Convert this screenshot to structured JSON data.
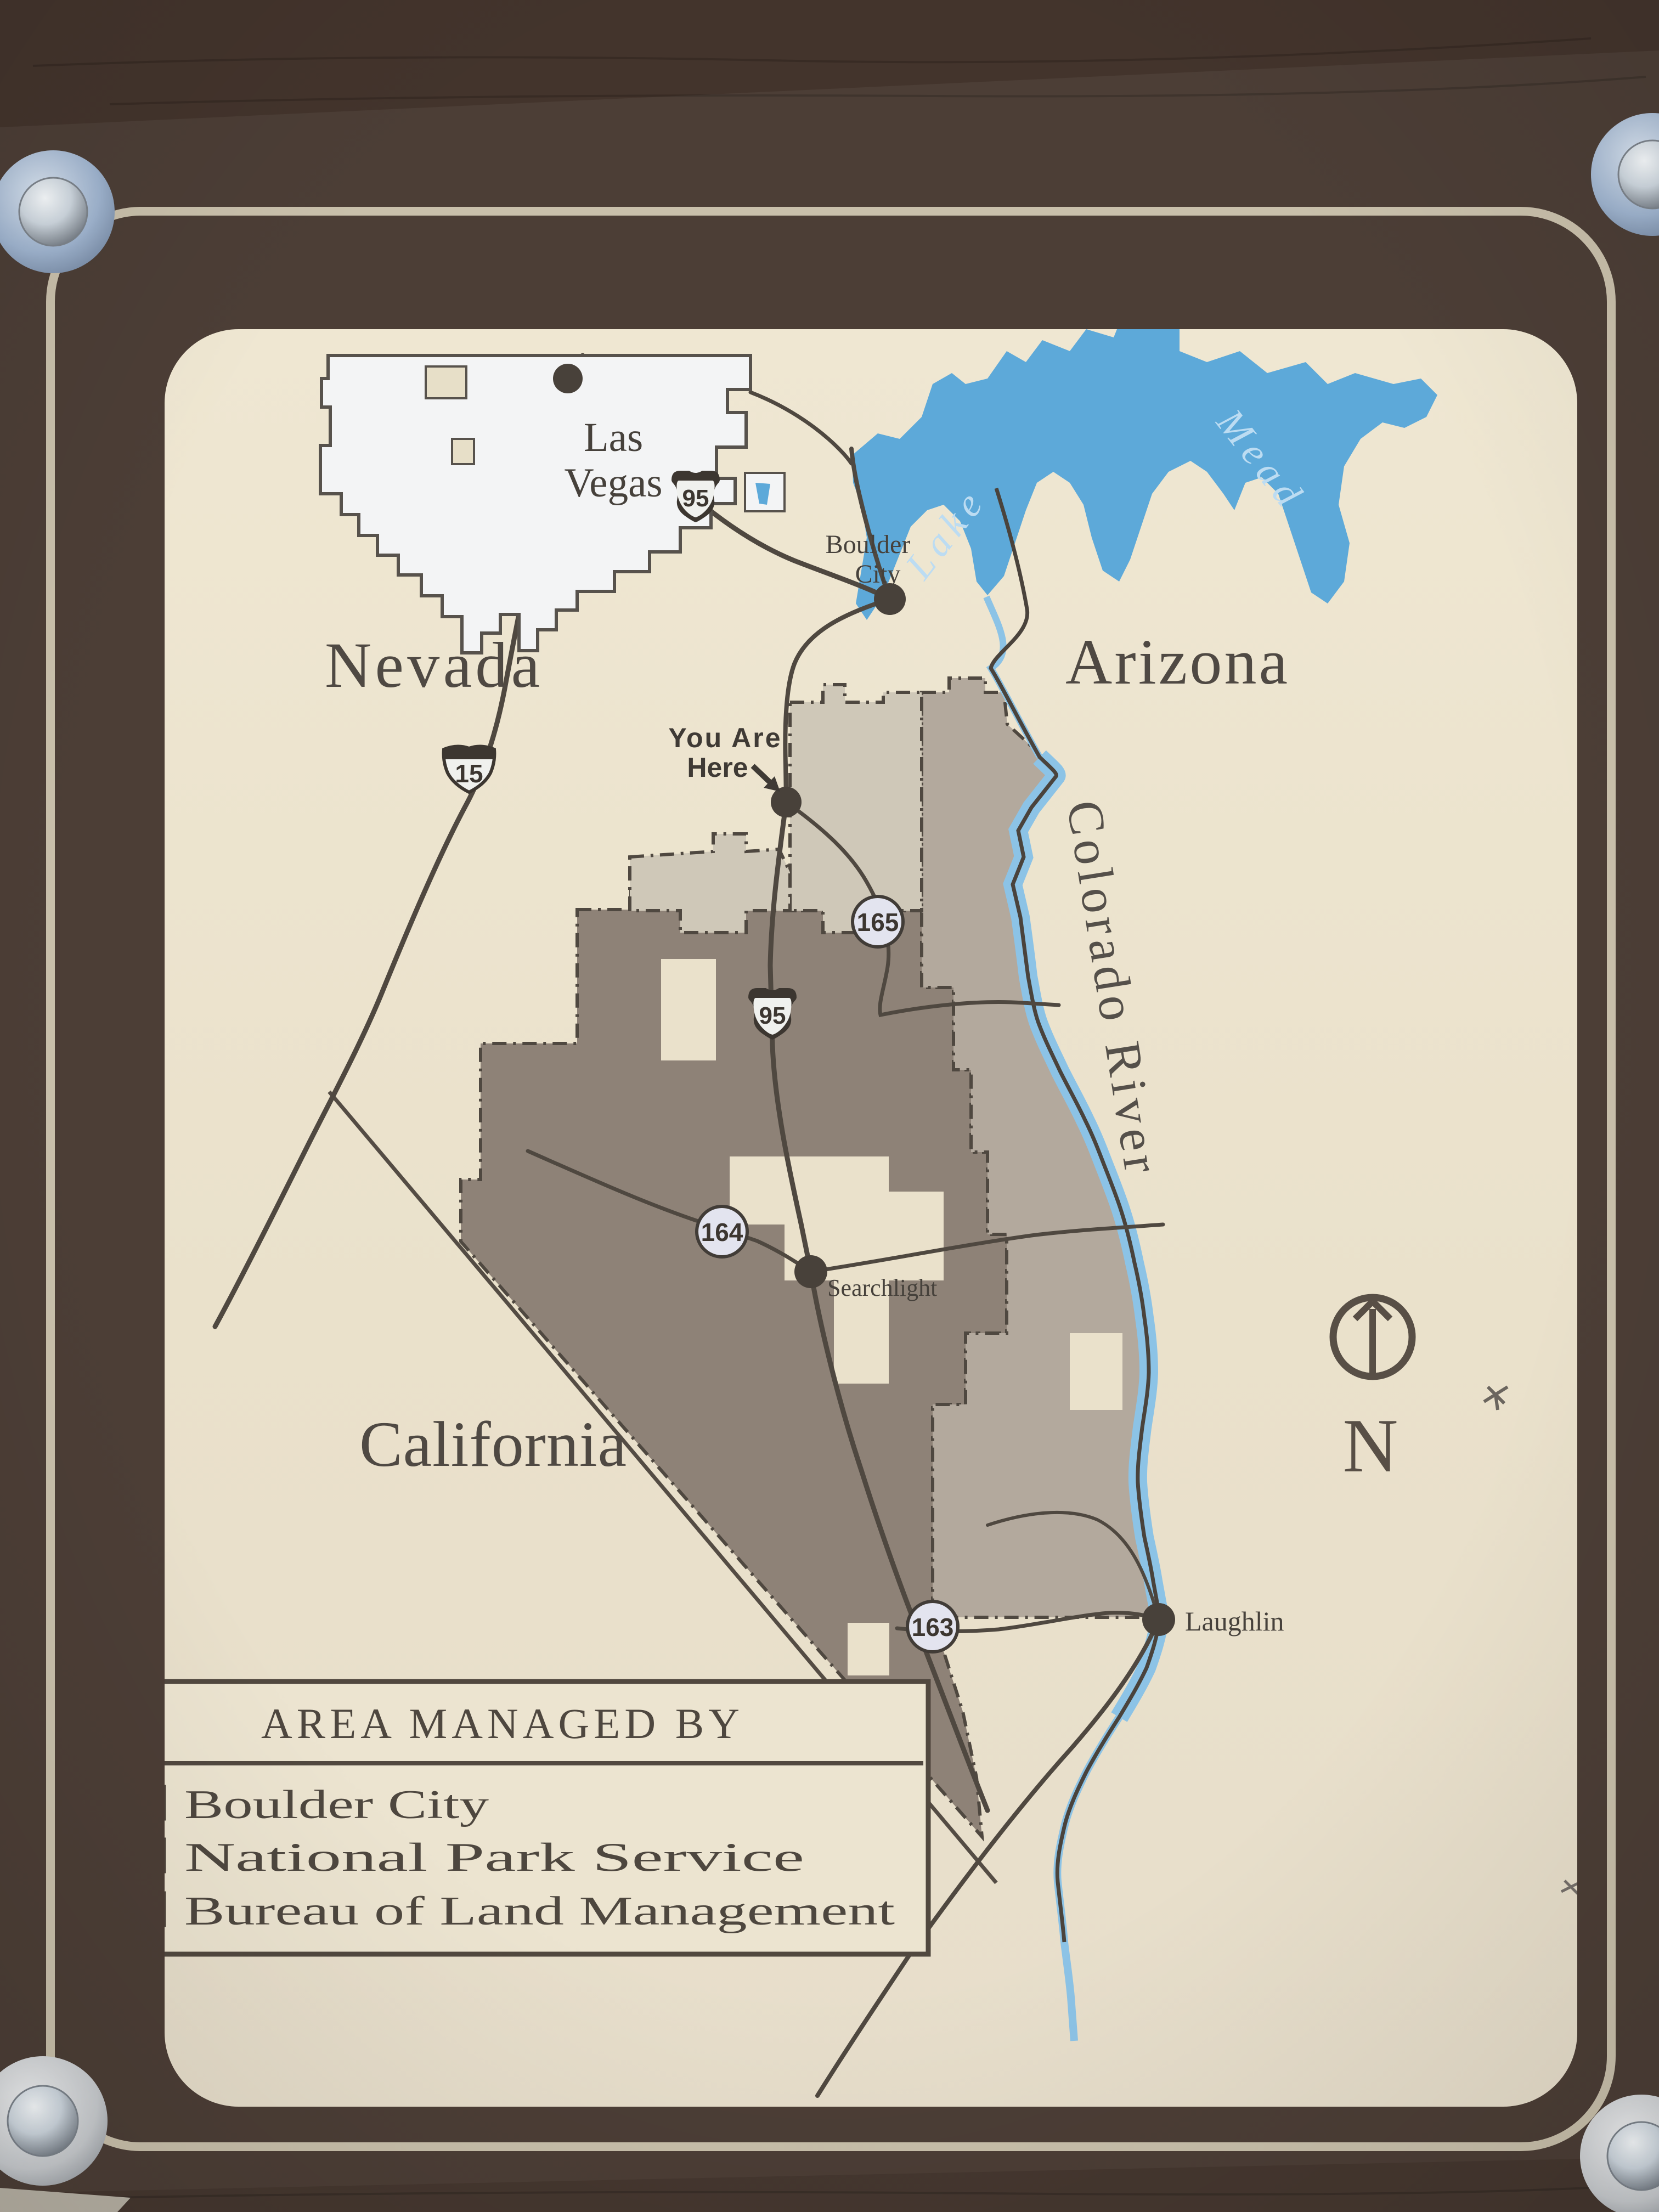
{
  "sign": {
    "region_labels": {
      "nevada": "Nevada",
      "arizona": "Arizona",
      "california": "California"
    },
    "water": {
      "lake_word1": "Lake",
      "lake_word2": "Mead",
      "river_label": "Colorado River"
    },
    "cities": {
      "las_vegas_line1": "Las",
      "las_vegas_line2": "Vegas",
      "boulder_line1": "Boulder",
      "boulder_line2": "City",
      "searchlight": "Searchlight",
      "laughlin": "Laughlin"
    },
    "you_are_here": {
      "line1": "You Are",
      "line2": "Here"
    },
    "routes": {
      "interstate_15": "15",
      "us_95": "95",
      "nv_165": "165",
      "nv_164": "164",
      "nv_163": "163"
    },
    "compass": {
      "north_label": "N"
    },
    "legend": {
      "title": "AREA MANAGED BY",
      "items": [
        {
          "label": "Boulder City",
          "color": "#d6cfbf"
        },
        {
          "label": "National Park Service",
          "color": "#b7ada1"
        },
        {
          "label": "Bureau of Land Management",
          "color": "#9a8d81"
        }
      ]
    },
    "colors": {
      "blm": "#8e8277",
      "nps": "#b3a99d",
      "boulder_city": "#cfc8b8",
      "cream": "#eae1cb",
      "lake": "#5da9d9",
      "river": "#8cc3e6",
      "wood": "#4c3e36",
      "pinstripe": "#c9c0ab",
      "line": "#4f4840"
    }
  }
}
